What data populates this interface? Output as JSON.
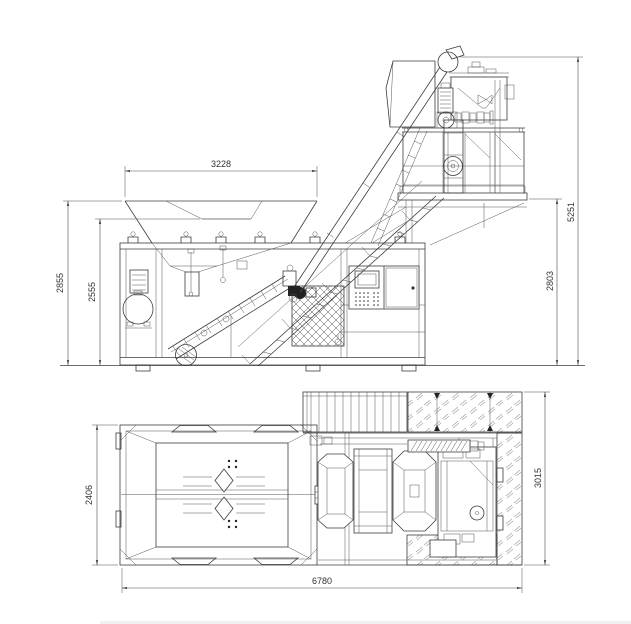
{
  "drawing": {
    "background": "#ffffff",
    "line_color": "#3c3c3c",
    "dimension_color": "#4a4a4a",
    "hatch_color": "#9a9a9a"
  },
  "dimensions": {
    "hopper_top_width": "3228",
    "left_height_outer": "2855",
    "left_height_inner": "2555",
    "total_height": "5251",
    "platform_height": "2803",
    "plan_width": "2406",
    "plan_depth": "3015",
    "overall_length": "6780"
  }
}
